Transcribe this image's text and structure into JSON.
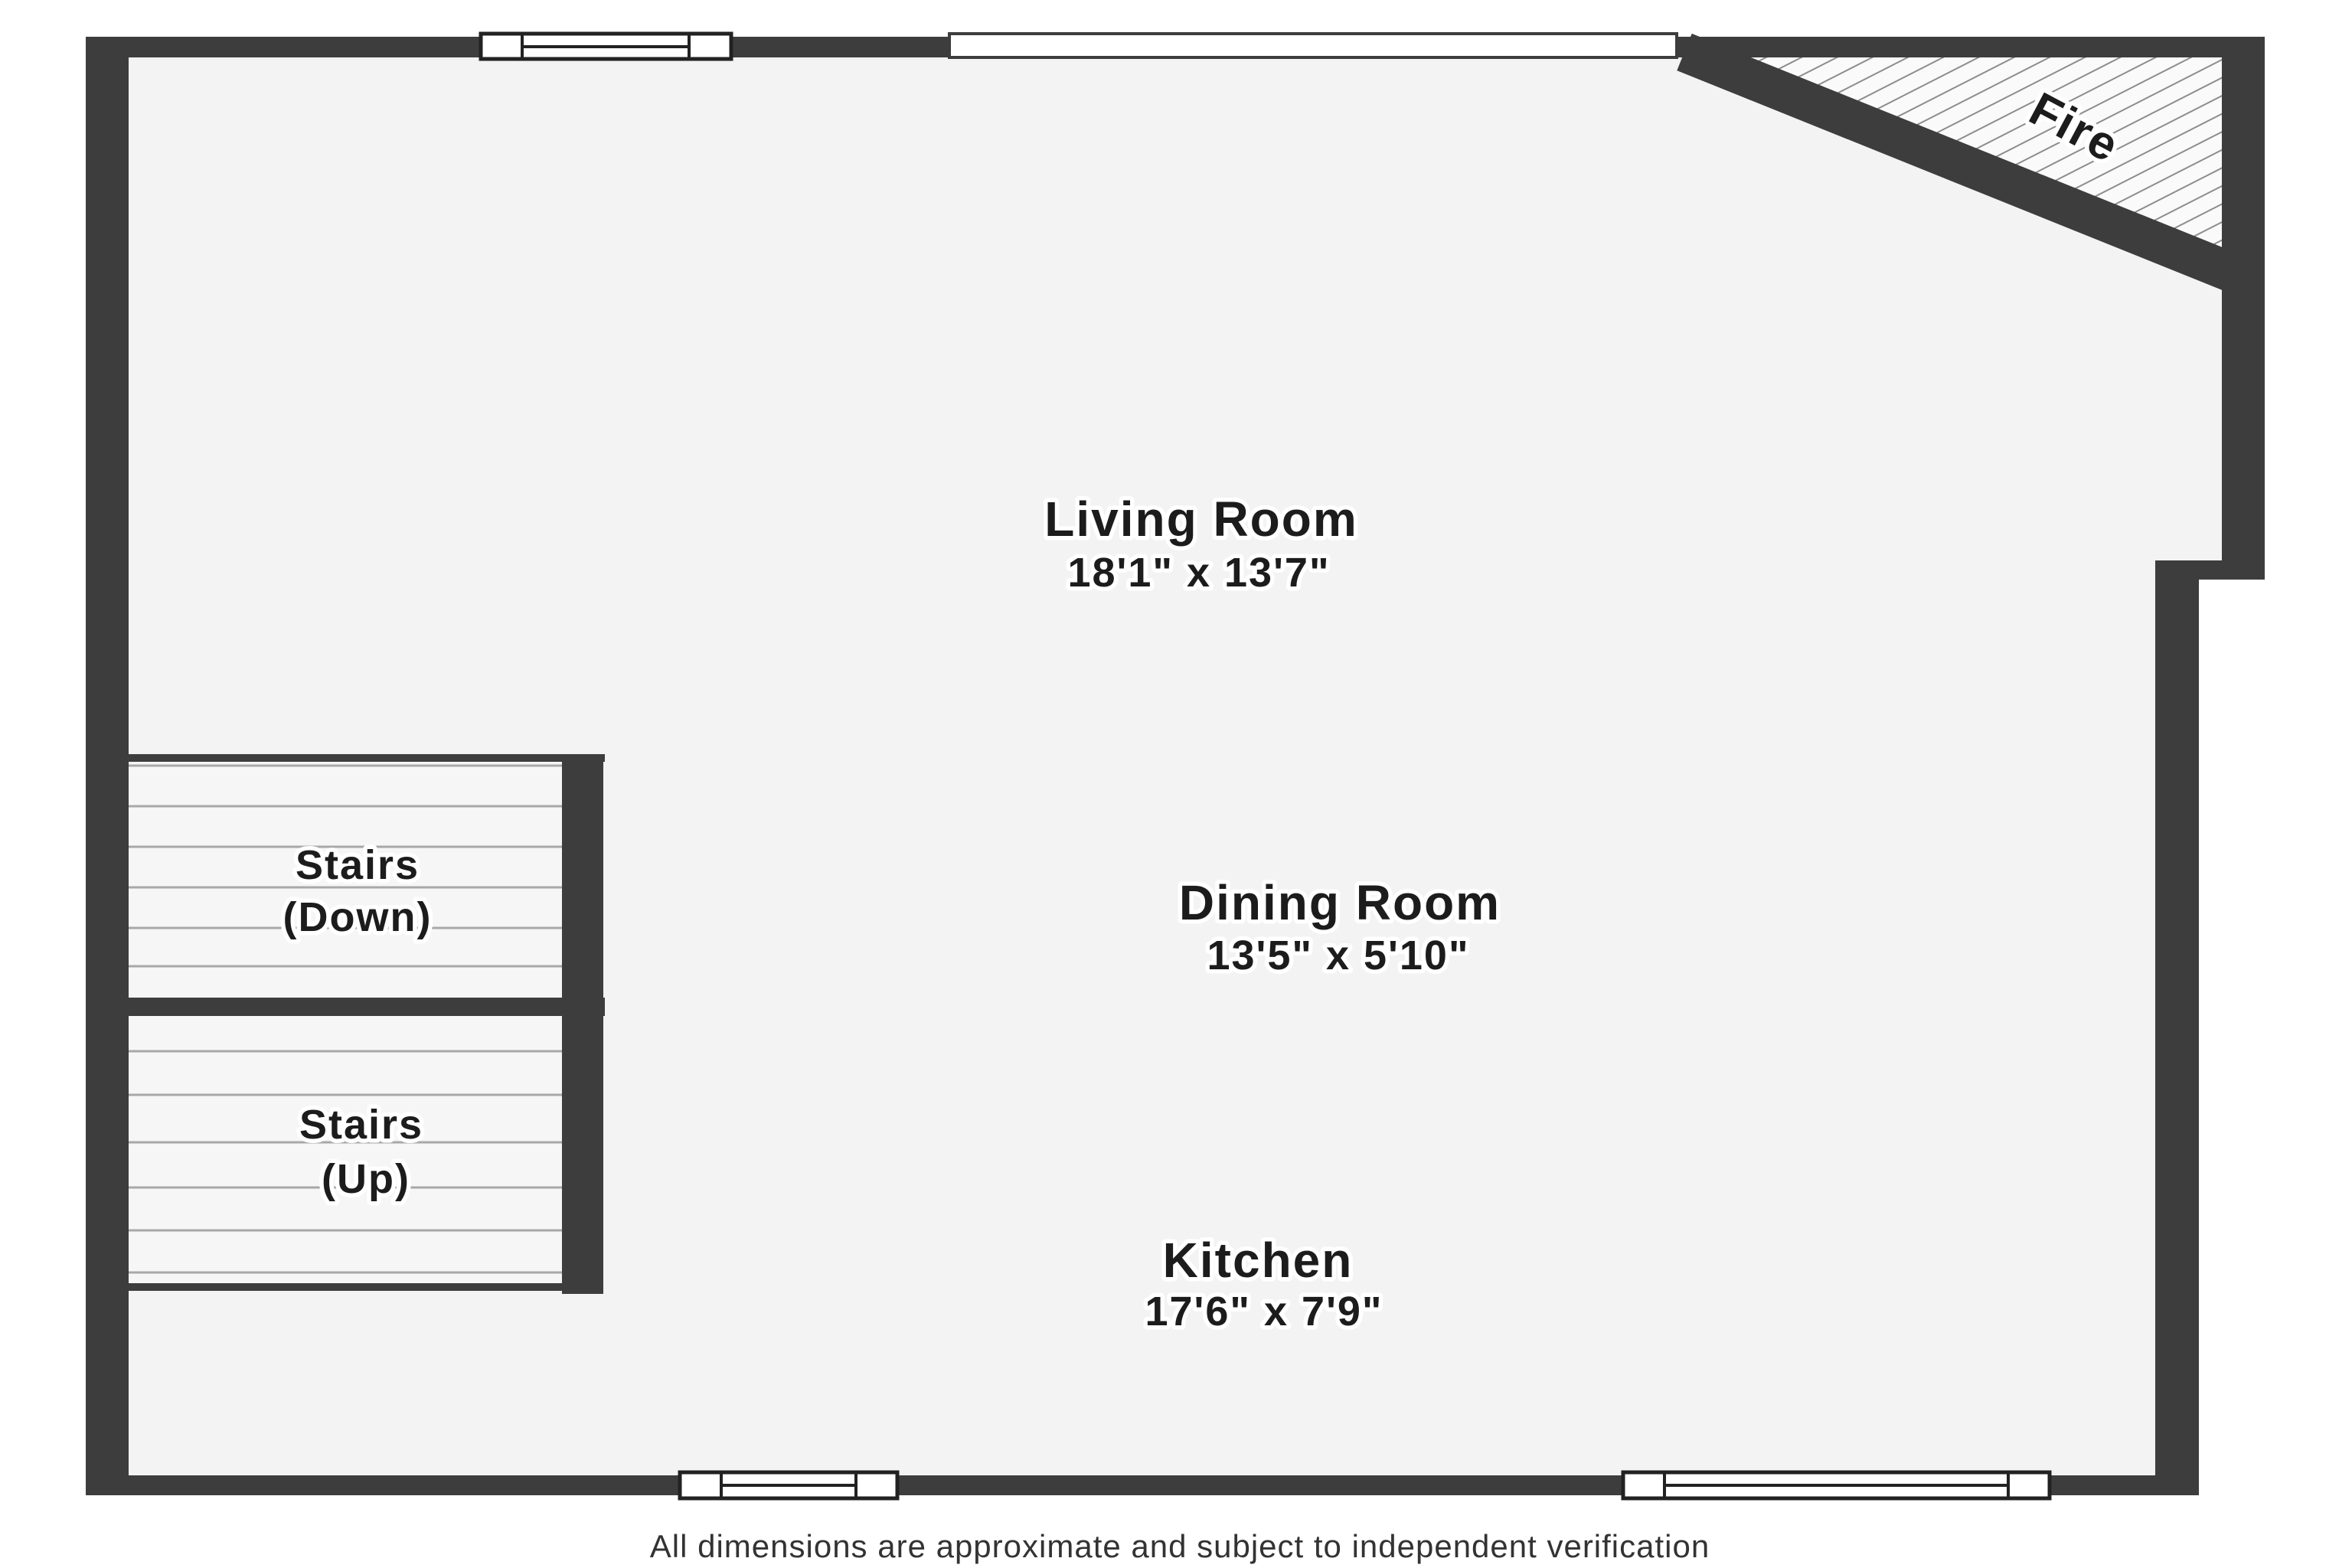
{
  "plan": {
    "rooms": [
      {
        "name": "Living Room",
        "dimensions": "18'1\" x 13'7\""
      },
      {
        "name": "Dining Room",
        "dimensions": "13'5\" x 5'10\""
      },
      {
        "name": "Kitchen",
        "dimensions": "17'6\" x 7'9\""
      }
    ],
    "stairs": [
      {
        "line1": "Stairs",
        "line2": "(Down)"
      },
      {
        "line1": "Stairs",
        "line2": "(Up)"
      }
    ],
    "fireplace_label": "Fire",
    "footer": "All dimensions are approximate and subject to independent verification",
    "colors": {
      "wall": "#3d3d3d",
      "floor": "#f3f3f3",
      "hatch": "#8d8d8d",
      "label_text": "#1c1c1c",
      "footer_text": "#333333",
      "tread_line": "#a8a8a8",
      "window_frame": "#222222"
    }
  }
}
